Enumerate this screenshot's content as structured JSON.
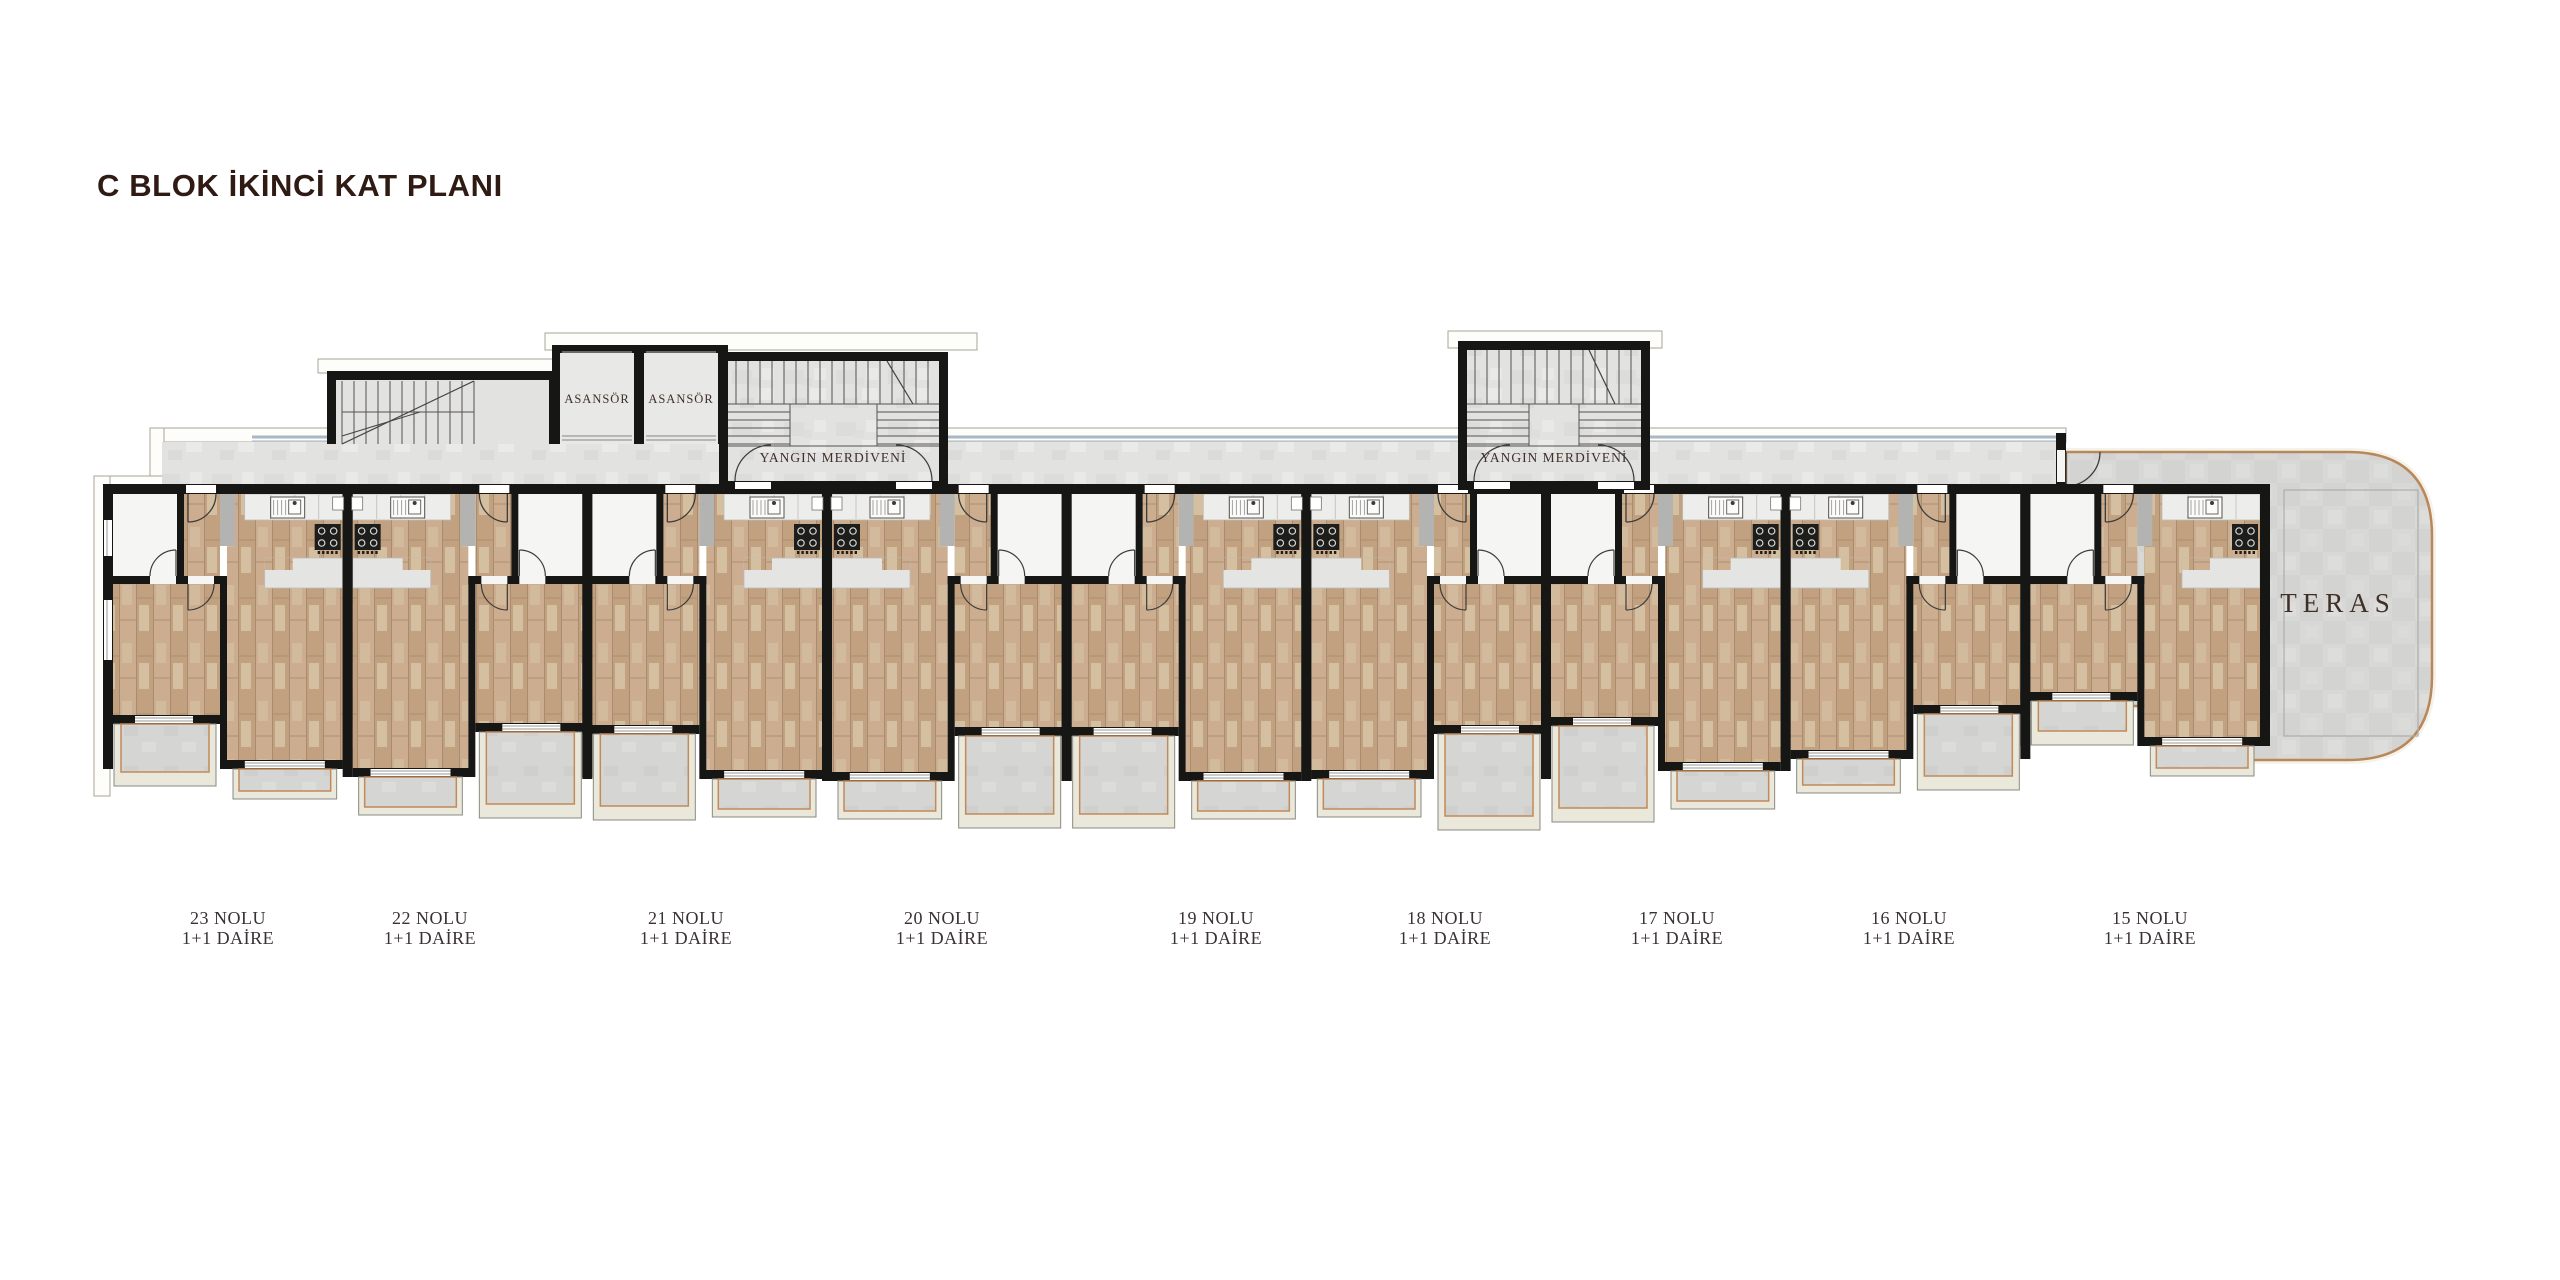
{
  "title": "C BLOK İKİNCİ KAT PLANI",
  "plan": {
    "elevator": {
      "label": "ASANSÖR",
      "cells": [
        {
          "cx": 597
        },
        {
          "cx": 681
        }
      ],
      "label_y": 403
    },
    "fire_escapes": [
      {
        "label": "YANGIN MERDİVENİ",
        "cx": 833,
        "label_y": 462
      },
      {
        "label": "YANGIN MERDİVENİ",
        "cx": 1554,
        "label_y": 462
      }
    ],
    "terrace": {
      "label": "TERAS",
      "cx": 2338,
      "cy": 612
    },
    "apartments": [
      {
        "number": "23 NOLU",
        "type": "1+1 DAİRE",
        "label_x": 228
      },
      {
        "number": "22 NOLU",
        "type": "1+1 DAİRE",
        "label_x": 430
      },
      {
        "number": "21 NOLU",
        "type": "1+1 DAİRE",
        "label_x": 686
      },
      {
        "number": "20 NOLU",
        "type": "1+1 DAİRE",
        "label_x": 942
      },
      {
        "number": "19 NOLU",
        "type": "1+1 DAİRE",
        "label_x": 1216
      },
      {
        "number": "18 NOLU",
        "type": "1+1 DAİRE",
        "label_x": 1445
      },
      {
        "number": "17 NOLU",
        "type": "1+1 DAİRE",
        "label_x": 1677
      },
      {
        "number": "16 NOLU",
        "type": "1+1 DAİRE",
        "label_x": 1909
      },
      {
        "number": "15 NOLU",
        "type": "1+1 DAİRE",
        "label_x": 2150
      }
    ],
    "label_y1": 924,
    "label_y2": 944,
    "colors": {
      "title": "#2f1b13",
      "apartment_label": "#3a3134",
      "room_label": "#402f28",
      "wall": "#161614",
      "wood": "#c6a888",
      "concrete": "#e2e2e0",
      "terrace_border": "#b9885a",
      "balcony_trim": "#c08a5a",
      "glazing_line": "#a9b8c4",
      "white_room": "#f5f5f3"
    }
  }
}
